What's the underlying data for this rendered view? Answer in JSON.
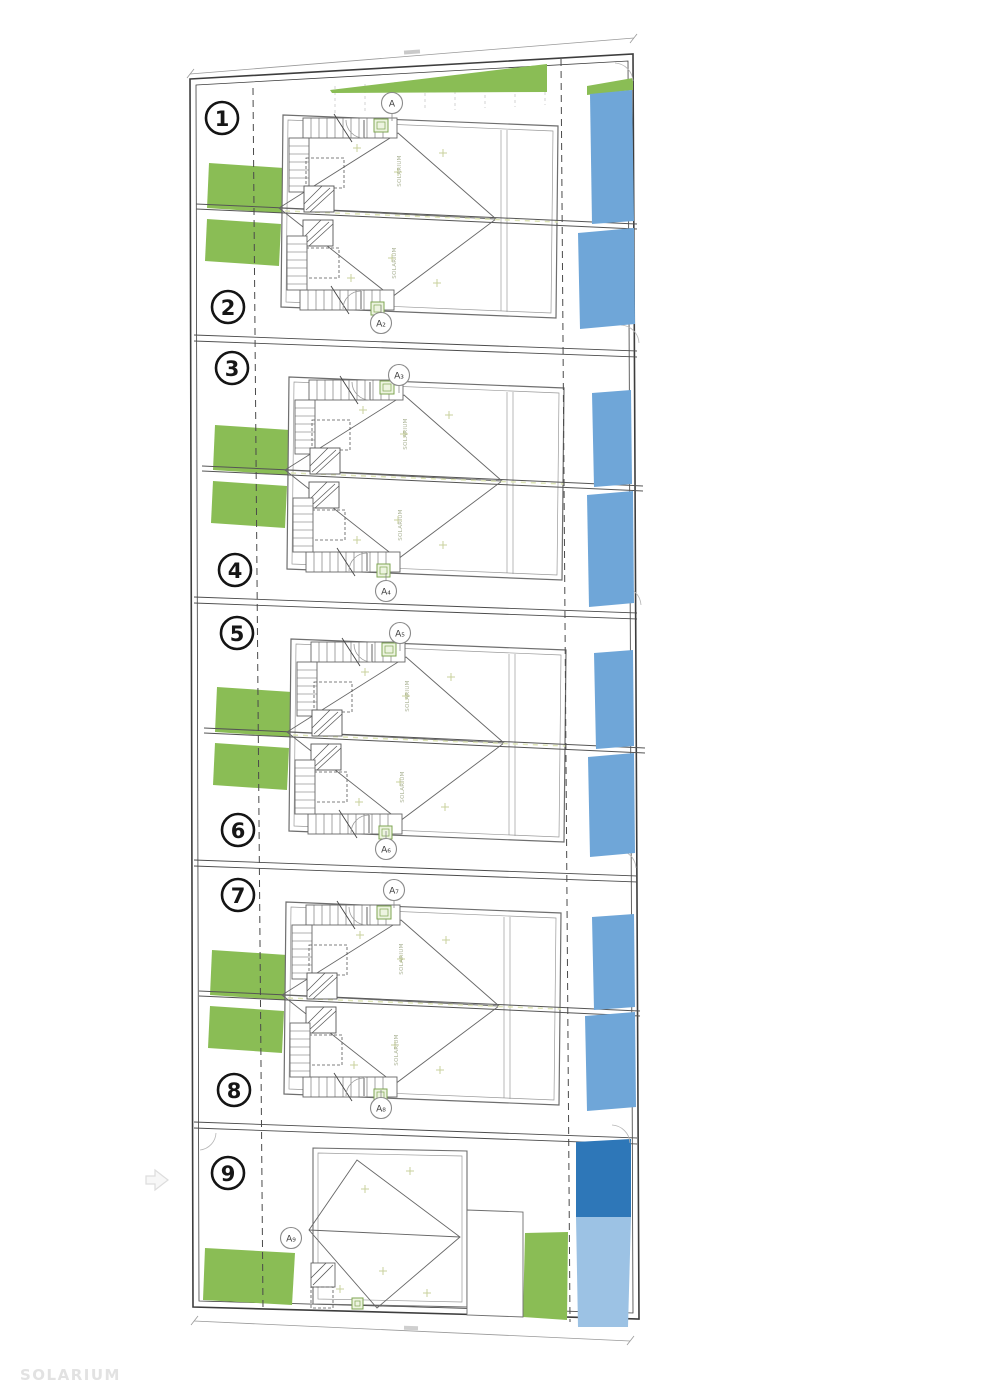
{
  "sheet": {
    "watermark": "SOLARIUM",
    "background_color": "#ffffff"
  },
  "colors": {
    "garden": "#8abd55",
    "pool": "#6fa6d8",
    "pool_dark": "#2e77b8",
    "pool_light": "#9cc2e4",
    "boundary": "#3d3d3d",
    "drawing_line": "#6e6e6e"
  },
  "roof_label": "SOLARIUM",
  "units": [
    {
      "number": "1"
    },
    {
      "number": "2"
    },
    {
      "number": "3"
    },
    {
      "number": "4"
    },
    {
      "number": "5"
    },
    {
      "number": "6"
    },
    {
      "number": "7"
    },
    {
      "number": "8"
    },
    {
      "number": "9"
    }
  ],
  "section_markers": [
    {
      "label": "A"
    },
    {
      "label": "A₂"
    },
    {
      "label": "A₃"
    },
    {
      "label": "A₄"
    },
    {
      "label": "A₅"
    },
    {
      "label": "A₆"
    },
    {
      "label": "A₇"
    },
    {
      "label": "A₈"
    },
    {
      "label": "A₉"
    }
  ]
}
